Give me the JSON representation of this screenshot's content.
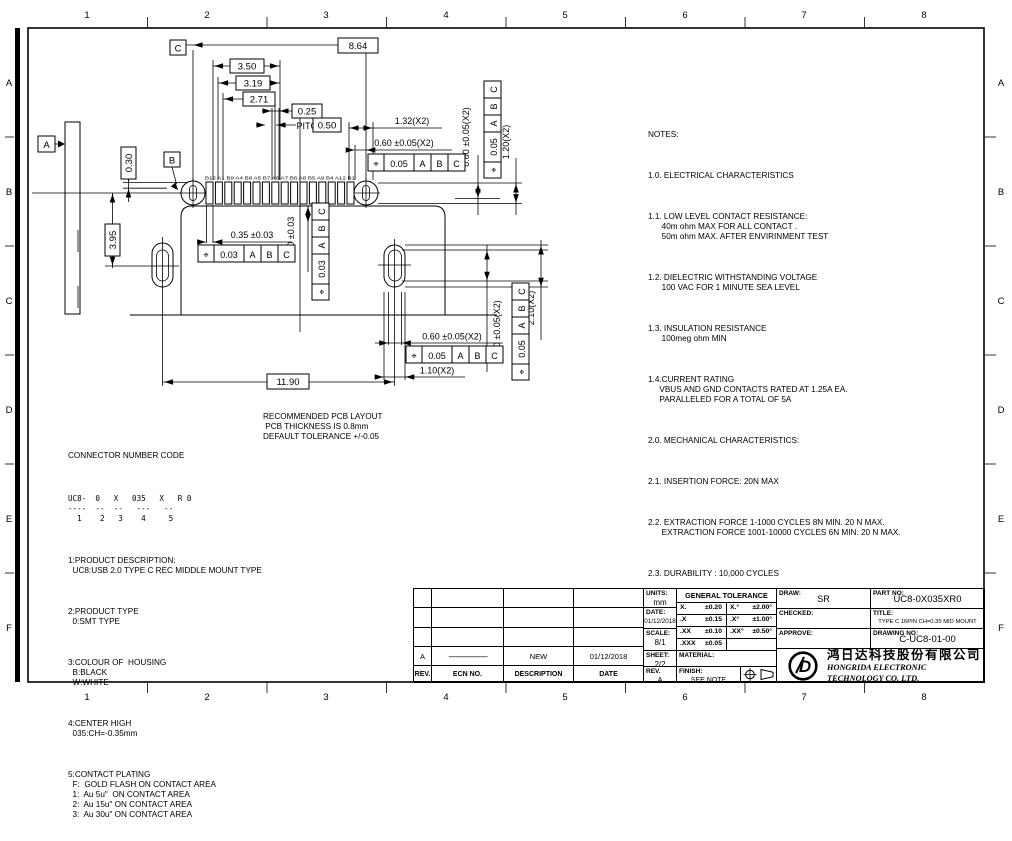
{
  "zones": {
    "cols": [
      "1",
      "2",
      "3",
      "4",
      "5",
      "6",
      "7",
      "8"
    ],
    "rows": [
      "A",
      "B",
      "C",
      "D",
      "E",
      "F"
    ]
  },
  "drawing": {
    "datum_a": "A",
    "datum_b": "B",
    "datum_c": "C",
    "dim_864": "8.64",
    "dim_350": "3.50",
    "dim_319": "3.19",
    "dim_271": "2.71",
    "dim_025": "0.25",
    "pitch_label": "PITCH",
    "dim_050": "0.50",
    "dim_132": "1.32(X2)",
    "dim_060_top": "0.60 ±0.05(X2)",
    "dim_080": "0.80 ±0.05(X2)",
    "dim_120": "1.20(X2)",
    "dim_030": "0.30",
    "dim_395": "3.95",
    "dim_035": "0.35 ±0.03",
    "dim_090": "0.90 ±0.03",
    "dim_1190": "11.90",
    "dim_060_bottom": "0.60 ±0.05(X2)",
    "dim_110": "1.10(X2)",
    "dim_160": "1.60 ±0.05(X2)",
    "dim_210": "2.10(X2)",
    "fcf": {
      "pos": "⌖",
      "tol_005": "0.05",
      "tol_003": "0.03",
      "ref_a": "A",
      "ref_b": "B",
      "ref_c": "C"
    },
    "pin_labels": "B12 A1 B9 A4 B8 A5 B7 A6 A7 B6 A8 B5 A9 B4 A12 B1",
    "pcb_note": "RECOMMENDED PCB LAYOUT\n PCB THICKNESS IS 0.8mm\nDEFAULT TOLERANCE +/-0.05"
  },
  "notes": {
    "paragraphs": [
      "NOTES:",
      "1.0. ELECTRICAL CHARACTERISTICS",
      "1.1. LOW LEVEL CONTACT RESISTANCE:\n      40m ohm MAX FOR ALL CONTACT .\n      50m ohm MAX. AFTER ENVIRINMENT TEST",
      "1.2. DIELECTRIC WITHSTANDING VOLTAGE\n      100 VAC FOR 1 MINUTE SEA LEVEL",
      "1.3. INSULATION RESISTANCE\n      100meg ohm MIN",
      "1.4.CURRENT RATING\n     VBUS AND GND CONTACTS RATED AT 1.25A EA.\n     PARALLELED FOR A TOTAL OF 5A",
      "2.0. MECHANICAL CHARACTERISTICS:",
      "2.1. INSERTION FORCE: 20N MAX",
      "2.2. EXTRACTION FORCE 1-1000 CYCLES 8N MIN. 20 N MAX.\n      EXTRACTION FORCE 1001-10000 CYCLES 6N MIN. 20 N MAX.",
      "2.3. DURABILITY : 10,000 CYCLES",
      "3.0 .OPERATING TEMPERATURE: -55° TO +85°"
    ]
  },
  "code": {
    "paragraphs": [
      "CONNECTOR NUMBER CODE",
      "UC8-  0   X   035   X   R 0\n----  --  --   ---   --\n  1    2   3    4     5",
      "1:PRODUCT DESCRIPTION:\n  UC8:USB 2.0 TYPE C REC MIDDLE MOUNT TYPE",
      "2:PRODUCT TYPE\n  0:SMT TYPE",
      "3:COLOUR OF  HOUSING\n  B:BLACK\n  W:WHITE",
      "4:CENTER HIGH\n  035:CH=-0.35mm",
      "5:CONTACT PLATING\n  F:  GOLD FLASH ON CONTACT AREA\n  1:  Au 5u\"  ON CONTACT AREA\n  2:  Au 15u\" ON CONTACT AREA\n  3:  Au 30u\" ON CONTACT AREA"
    ]
  },
  "titleblock": {
    "rev_table": {
      "headers": [
        "REV.",
        "ECN NO.",
        "DESCRIPTION",
        "DATE"
      ],
      "row": {
        "rev": "A",
        "ecn": "—————",
        "desc": "NEW",
        "date": "01/12/2018"
      }
    },
    "units_label": "UNITS:",
    "units": "mm",
    "date_label": "DATE:",
    "date": "01/12/2018",
    "scale_label": "SCALE:",
    "scale": "8/1",
    "sheet_label": "SHEET:",
    "sheet": "2/2",
    "rev_label": "REV.",
    "rev": "A",
    "gt_title": "GENERAL TOLERANCE",
    "gt_left": [
      [
        "X.",
        "±0.20"
      ],
      [
        ".X",
        "±0.15"
      ],
      [
        ".XX",
        "±0.10"
      ],
      [
        ".XXX",
        "±0.05"
      ]
    ],
    "gt_right": [
      [
        "X.°",
        "±2.00°"
      ],
      [
        ".X°",
        "±1.00°"
      ],
      [
        ".XX°",
        "±0.50°"
      ]
    ],
    "material_label": "MATERIAL:",
    "finish_label": "FINISH:",
    "finish": "SEE NOTE",
    "draw_label": "DRAW:",
    "draw": "SR",
    "checked_label": "CHECKED:",
    "approve_label": "APPROVE:",
    "partno_label": "PART NO:",
    "partno": "UC8-0X035XR0",
    "title_label": "TITLE:",
    "title": "TYPE C 16PIN CH=0.35 MID MOUNT TYPE",
    "drawingno_label": "DRAWING NO:",
    "drawingno": "C-UC8-01-00",
    "company_cn": "鸿日达科技股份有限公司",
    "company_en": "HONGRIDA ELECTRONIC TECHNOLOGY CO, LTD.",
    "logo": "D"
  }
}
